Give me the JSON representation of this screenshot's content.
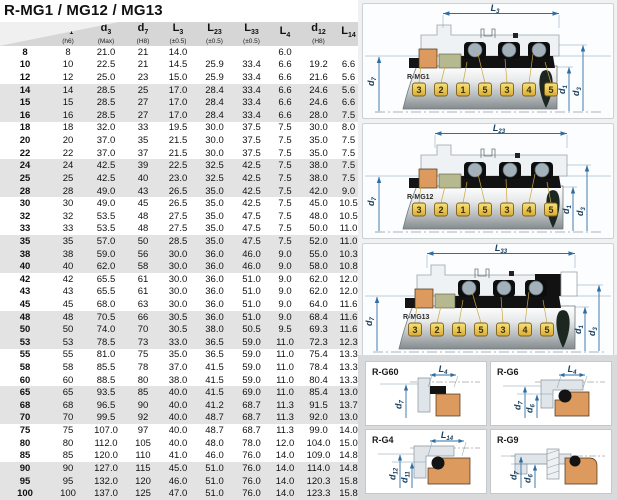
{
  "page_title": "R-MG1 / MG12 / MG13",
  "table": {
    "columns": [
      {
        "main": "",
        "sub": "",
        "note": ""
      },
      {
        "main": "d",
        "sub": "1",
        "note": "(h6)"
      },
      {
        "main": "d",
        "sub": "3",
        "note": "(Max)"
      },
      {
        "main": "d",
        "sub": "7",
        "note": "(H8)"
      },
      {
        "main": "L",
        "sub": "3",
        "note": "(±0.5)"
      },
      {
        "main": "L",
        "sub": "23",
        "note": "(±0.5)"
      },
      {
        "main": "L",
        "sub": "33",
        "note": "(±0.5)"
      },
      {
        "main": "L",
        "sub": "4",
        "note": ""
      },
      {
        "main": "d",
        "sub": "12",
        "note": "(H8)"
      },
      {
        "main": "L",
        "sub": "14",
        "note": ""
      }
    ],
    "rows": [
      [
        "8",
        "8",
        "21.0",
        "21",
        "14.0",
        "",
        "",
        "6.0",
        "",
        ""
      ],
      [
        "10",
        "10",
        "22.5",
        "21",
        "14.5",
        "25.9",
        "33.4",
        "6.6",
        "19.2",
        "6.6"
      ],
      [
        "12",
        "12",
        "25.0",
        "23",
        "15.0",
        "25.9",
        "33.4",
        "6.6",
        "21.6",
        "5.6"
      ],
      [
        "14",
        "14",
        "28.5",
        "25",
        "17.0",
        "28.4",
        "33.4",
        "6.6",
        "24.6",
        "5.6"
      ],
      [
        "15",
        "15",
        "28.5",
        "27",
        "17.0",
        "28.4",
        "33.4",
        "6.6",
        "24.6",
        "6.6"
      ],
      [
        "16",
        "16",
        "28.5",
        "27",
        "17.0",
        "28.4",
        "33.4",
        "6.6",
        "28.0",
        "7.5"
      ],
      [
        "18",
        "18",
        "32.0",
        "33",
        "19.5",
        "30.0",
        "37.5",
        "7.5",
        "30.0",
        "8.0"
      ],
      [
        "20",
        "20",
        "37.0",
        "35",
        "21.5",
        "30.0",
        "37.5",
        "7.5",
        "35.0",
        "7.5"
      ],
      [
        "22",
        "22",
        "37.0",
        "37",
        "21.5",
        "30.0",
        "37.5",
        "7.5",
        "35.0",
        "7.5"
      ],
      [
        "24",
        "24",
        "42.5",
        "39",
        "22.5",
        "32.5",
        "42.5",
        "7.5",
        "38.0",
        "7.5"
      ],
      [
        "25",
        "25",
        "42.5",
        "40",
        "23.0",
        "32.5",
        "42.5",
        "7.5",
        "38.0",
        "7.5"
      ],
      [
        "28",
        "28",
        "49.0",
        "43",
        "26.5",
        "35.0",
        "42.5",
        "7.5",
        "42.0",
        "9.0"
      ],
      [
        "30",
        "30",
        "49.0",
        "45",
        "26.5",
        "35.0",
        "42.5",
        "7.5",
        "45.0",
        "10.5"
      ],
      [
        "32",
        "32",
        "53.5",
        "48",
        "27.5",
        "35.0",
        "47.5",
        "7.5",
        "48.0",
        "10.5"
      ],
      [
        "33",
        "33",
        "53.5",
        "48",
        "27.5",
        "35.0",
        "47.5",
        "7.5",
        "50.0",
        "11.0"
      ],
      [
        "35",
        "35",
        "57.0",
        "50",
        "28.5",
        "35.0",
        "47.5",
        "7.5",
        "52.0",
        "11.0"
      ],
      [
        "38",
        "38",
        "59.0",
        "56",
        "30.0",
        "36.0",
        "46.0",
        "9.0",
        "55.0",
        "10.3"
      ],
      [
        "40",
        "40",
        "62.0",
        "58",
        "30.0",
        "36.0",
        "46.0",
        "9.0",
        "58.0",
        "10.8"
      ],
      [
        "42",
        "42",
        "65.5",
        "61",
        "30.0",
        "36.0",
        "51.0",
        "9.0",
        "62.0",
        "12.0"
      ],
      [
        "43",
        "43",
        "65.5",
        "61",
        "30.0",
        "36.0",
        "51.0",
        "9.0",
        "62.0",
        "12.0"
      ],
      [
        "45",
        "45",
        "68.0",
        "63",
        "30.0",
        "36.0",
        "51.0",
        "9.0",
        "64.0",
        "11.6"
      ],
      [
        "48",
        "48",
        "70.5",
        "66",
        "30.5",
        "36.0",
        "51.0",
        "9.0",
        "68.4",
        "11.6"
      ],
      [
        "50",
        "50",
        "74.0",
        "70",
        "30.5",
        "38.0",
        "50.5",
        "9.5",
        "69.3",
        "11.6"
      ],
      [
        "53",
        "53",
        "78.5",
        "73",
        "33.0",
        "36.5",
        "59.0",
        "11.0",
        "72.3",
        "12.3"
      ],
      [
        "55",
        "55",
        "81.0",
        "75",
        "35.0",
        "36.5",
        "59.0",
        "11.0",
        "75.4",
        "13.3"
      ],
      [
        "58",
        "58",
        "85.5",
        "78",
        "37.0",
        "41.5",
        "59.0",
        "11.0",
        "78.4",
        "13.3"
      ],
      [
        "60",
        "60",
        "88.5",
        "80",
        "38.0",
        "41.5",
        "59.0",
        "11.0",
        "80.4",
        "13.3"
      ],
      [
        "65",
        "65",
        "93.5",
        "85",
        "40.0",
        "41.5",
        "69.0",
        "11.0",
        "85.4",
        "13.0"
      ],
      [
        "68",
        "68",
        "96.5",
        "90",
        "40.0",
        "41.2",
        "68.7",
        "11.3",
        "91.5",
        "13.7"
      ],
      [
        "70",
        "70",
        "99.5",
        "92",
        "40.0",
        "48.7",
        "68.7",
        "11.3",
        "92.0",
        "13.0"
      ],
      [
        "75",
        "75",
        "107.0",
        "97",
        "40.0",
        "48.7",
        "68.7",
        "11.3",
        "99.0",
        "14.0"
      ],
      [
        "80",
        "80",
        "112.0",
        "105",
        "40.0",
        "48.0",
        "78.0",
        "12.0",
        "104.0",
        "15.0"
      ],
      [
        "85",
        "85",
        "120.0",
        "110",
        "41.0",
        "46.0",
        "76.0",
        "14.0",
        "109.0",
        "14.8"
      ],
      [
        "90",
        "90",
        "127.0",
        "115",
        "45.0",
        "51.0",
        "76.0",
        "14.0",
        "114.0",
        "14.8"
      ],
      [
        "95",
        "95",
        "132.0",
        "120",
        "46.0",
        "51.0",
        "76.0",
        "14.0",
        "120.3",
        "15.8"
      ],
      [
        "100",
        "100",
        "137.0",
        "125",
        "47.0",
        "51.0",
        "76.0",
        "14.0",
        "123.3",
        "15.8"
      ]
    ]
  },
  "diagrams": [
    {
      "name": "R-MG1",
      "dim": {
        "main": "L",
        "sub": "3"
      },
      "d_left": {
        "main": "d",
        "sub": "7"
      },
      "d_inner": {
        "main": "d",
        "sub": "1"
      },
      "d_outer": {
        "main": "d",
        "sub": "3"
      },
      "tags": [
        "3",
        "2",
        "1",
        "5",
        "3",
        "4",
        "5"
      ]
    },
    {
      "name": "R-MG12",
      "dim": {
        "main": "L",
        "sub": "23"
      },
      "d_left": {
        "main": "d",
        "sub": "7"
      },
      "d_inner": {
        "main": "d",
        "sub": "1"
      },
      "d_outer": {
        "main": "d",
        "sub": "3"
      },
      "tags": [
        "3",
        "2",
        "1",
        "5",
        "3",
        "4",
        "5"
      ]
    },
    {
      "name": "R-MG13",
      "dim": {
        "main": "L",
        "sub": "33"
      },
      "d_left": {
        "main": "d",
        "sub": "7"
      },
      "d_inner": {
        "main": "d",
        "sub": "1"
      },
      "d_outer": {
        "main": "d",
        "sub": "3"
      },
      "tags": [
        "3",
        "2",
        "1",
        "5",
        "3",
        "4",
        "5"
      ]
    }
  ],
  "detail_diagrams": [
    {
      "name": "R-G60",
      "top": {
        "main": "L",
        "sub": "4"
      },
      "v1": {
        "main": "d",
        "sub": "7"
      },
      "v2": null
    },
    {
      "name": "R-G6",
      "top": {
        "main": "L",
        "sub": "4"
      },
      "v1": {
        "main": "d",
        "sub": "7"
      },
      "v2": {
        "main": "d",
        "sub": "6"
      }
    },
    {
      "name": "R-G4",
      "top": {
        "main": "L",
        "sub": "14"
      },
      "v1": {
        "main": "d",
        "sub": "12"
      },
      "v2": {
        "main": "d",
        "sub": "11"
      }
    },
    {
      "name": "R-G9",
      "top": null,
      "v1": {
        "main": "d",
        "sub": "7"
      },
      "v2": {
        "main": "d",
        "sub": "6"
      }
    }
  ],
  "colors": {
    "header_gray": "#d6d6d6",
    "band_gray": "#e3e3e3",
    "dimension_blue": "#2f6ea5",
    "seat_orange": "#dc9a5e",
    "ring_olive": "#b6b890",
    "elastomer_black": "#121212",
    "tag_yellow": "#e9c34f",
    "shaft_steel": "#b7bcbe"
  }
}
